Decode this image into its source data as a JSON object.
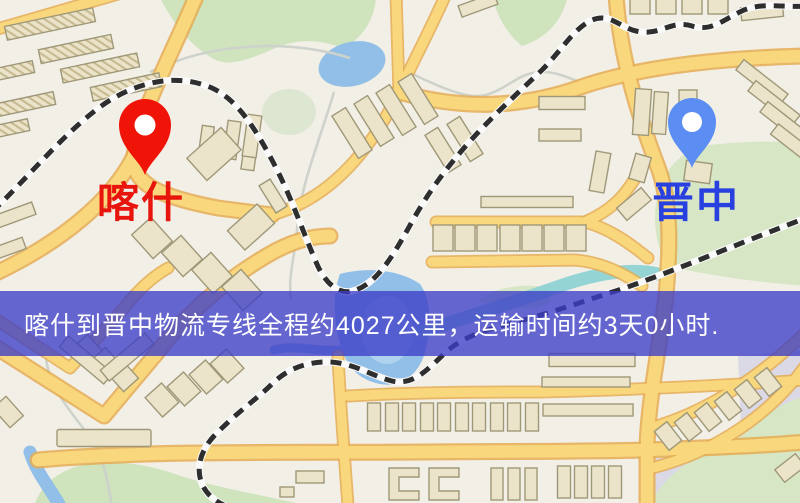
{
  "map": {
    "background_color": "#f2efe7",
    "road_color": "#f9d77d",
    "park_color": "#cfe3bd",
    "water_color": "#92bfe8",
    "railway_color": "#2e2e2e"
  },
  "markers": {
    "origin": {
      "label": "喀什",
      "pin_color": "#f01408",
      "label_color": "#e8150d"
    },
    "destination": {
      "label": "晋中",
      "pin_color": "#5b8df2",
      "label_color": "#2840e0"
    }
  },
  "banner": {
    "text": "喀什到晋中物流专线全程约4027公里，运输时间约3天0小时.",
    "background_color": "#3c3ec6",
    "text_color": "#ffffff",
    "distance_km": "4027",
    "duration": "3天0小时"
  }
}
